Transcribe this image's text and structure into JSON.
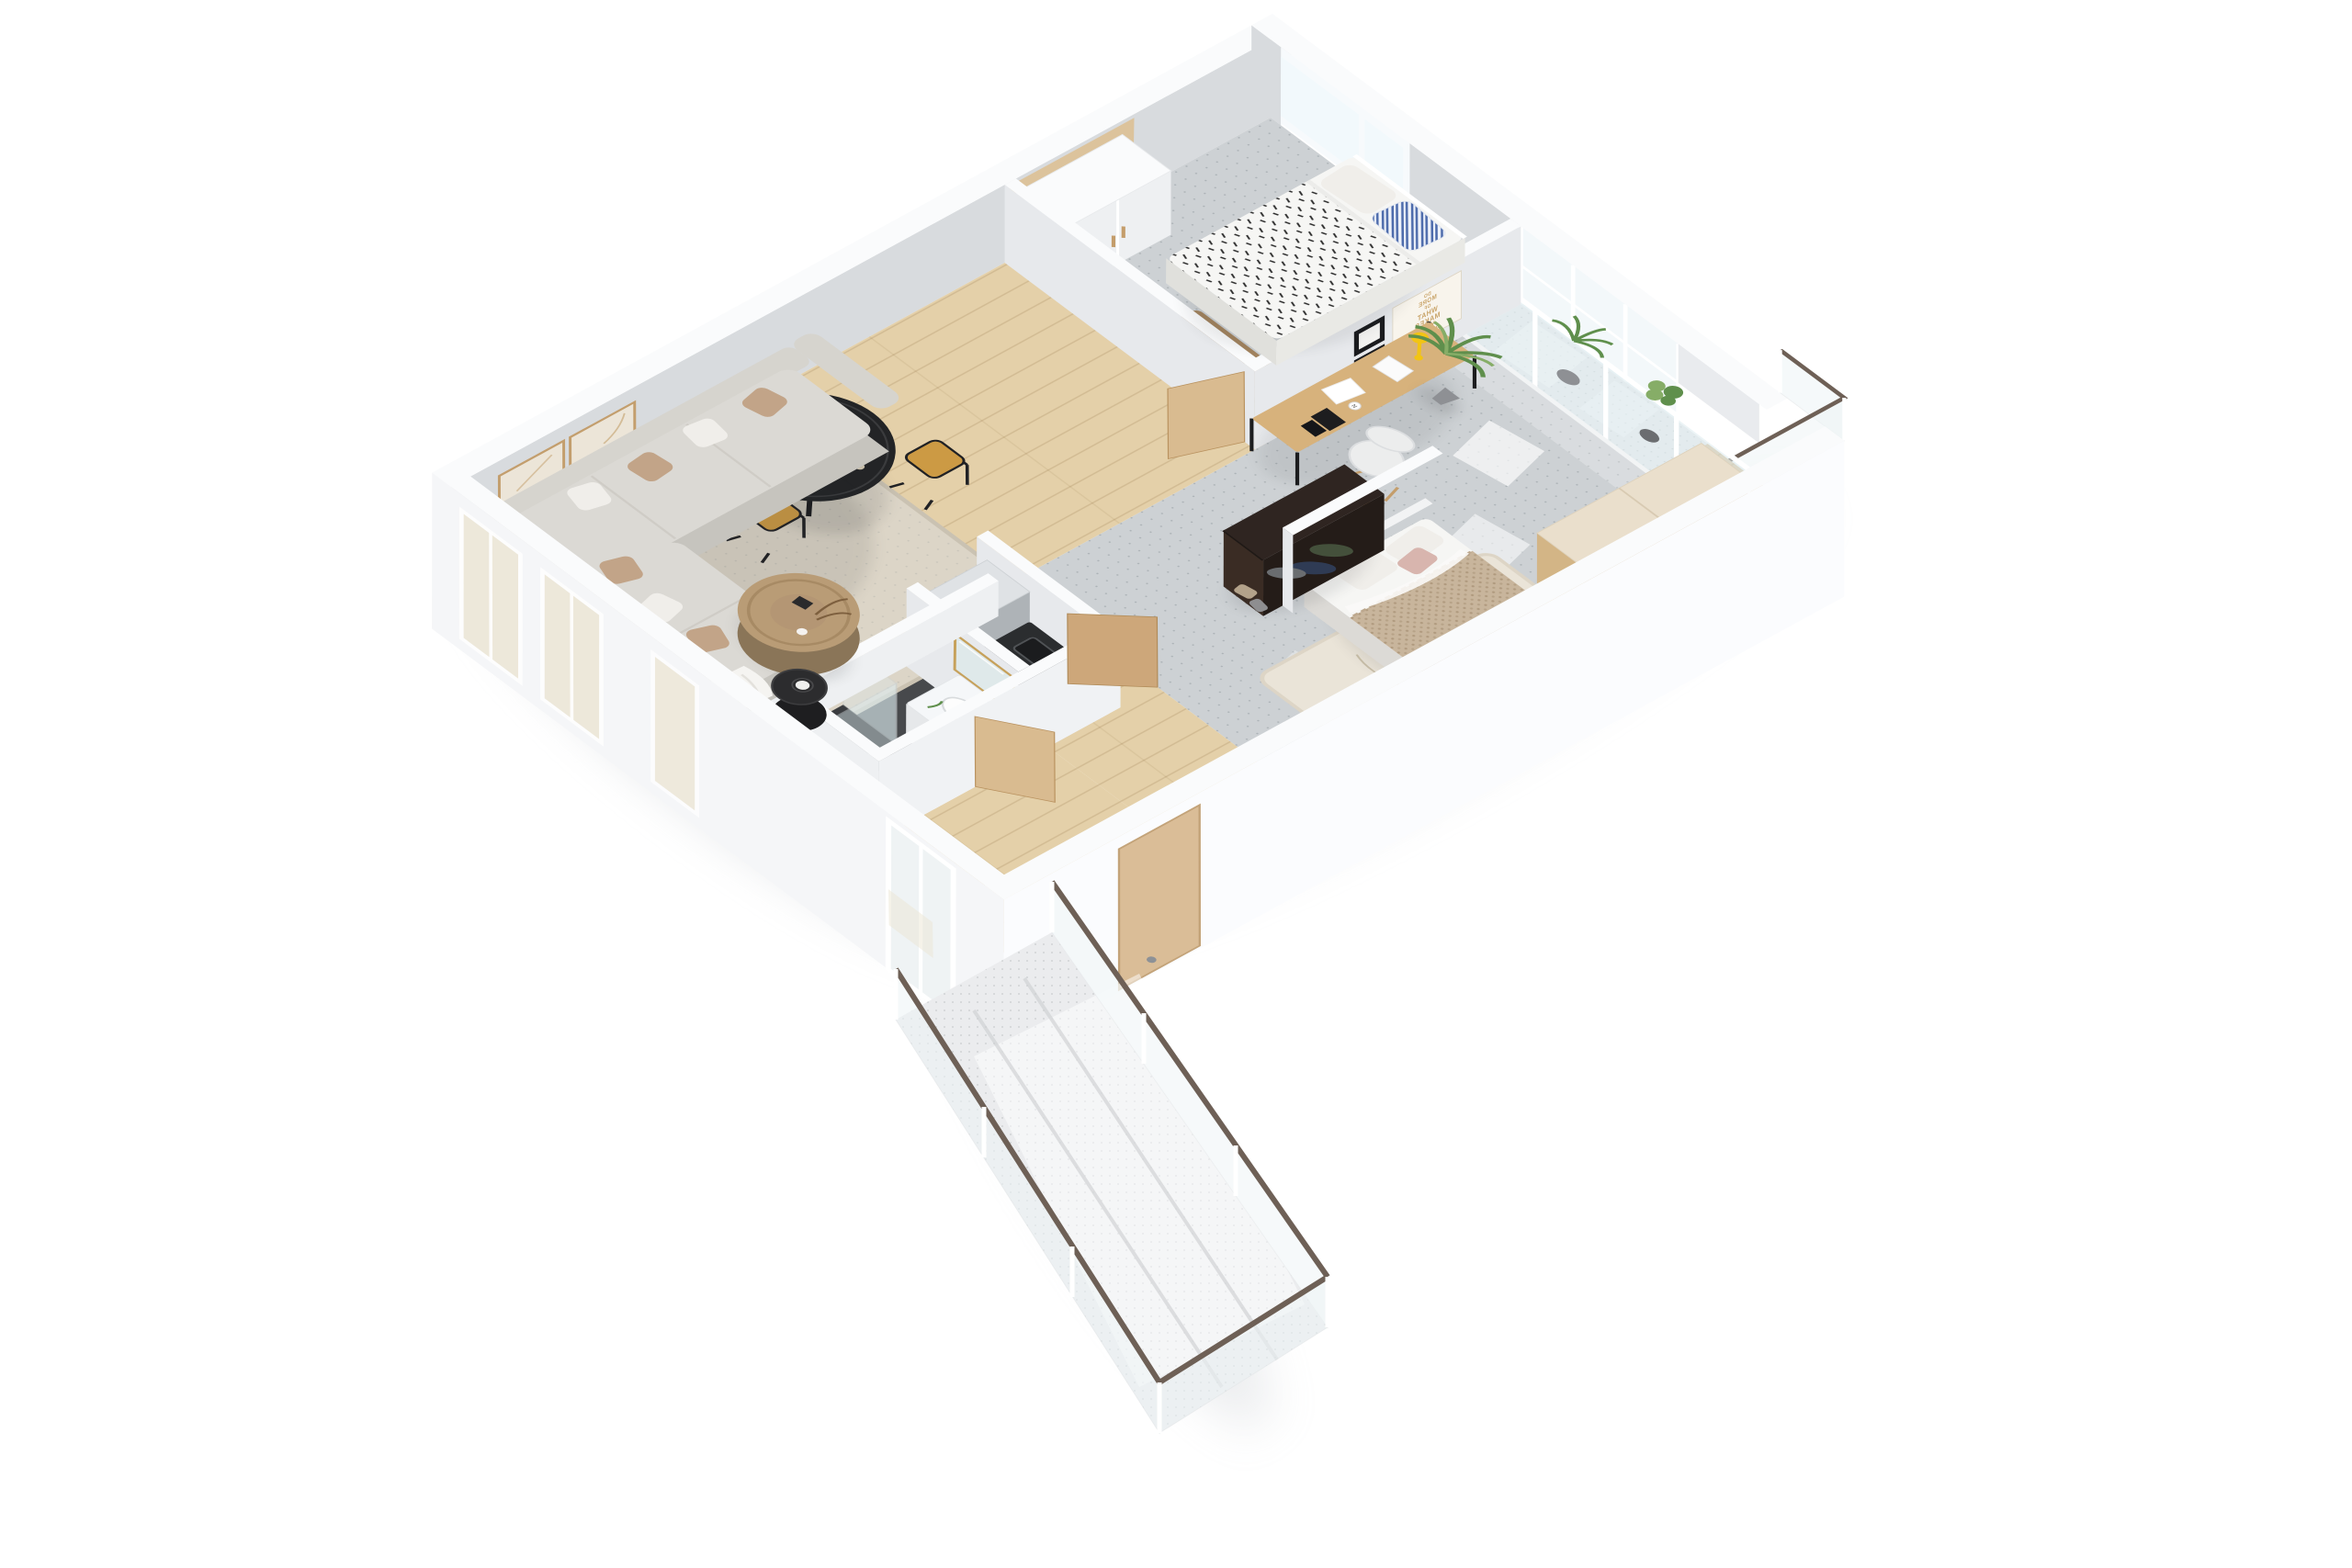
{
  "palette": {
    "bg": "#ffffff",
    "wallTop": "#fafbfc",
    "wallFace": "#d8dbde",
    "wallFaceLight": "#e7e9ec",
    "outerWall": "#f5f6f8",
    "outerWallBright": "#fbfcfe",
    "woodFloor": "#e4d0a9",
    "plankLine": "#d2ba8e",
    "carpet": "#cdd1d4",
    "carpetDot": "#9aa3a8",
    "bathFloor": "#47494c",
    "balconyFloor": "#ebecee",
    "deckWood": "#d9c29b",
    "woodPanel": "#dcc39c",
    "rugBeige": "#dcd5c7",
    "rugCream": "#eae4d8",
    "rugBrown": "#a3845f",
    "sofaBase": "#c6c4be",
    "sofaCushion": "#dbd9d4",
    "sofaBack": "#d6d4ce",
    "pillowTan": "#c2a488",
    "pillowWhite": "#f0eeea",
    "blanketWhite": "#f5f4f1",
    "tableBlack": "#232426",
    "rattan": "#cc9a44",
    "orangeFruit": "#e98e2b",
    "trunkWood": "#b99c76",
    "sideTableBlack": "#2c2c2e",
    "fridgeSteel": "#c6cacd",
    "fridgeSide": "#aeb3b7",
    "fridgeTop": "#dfe2e5",
    "counterDark": "#2b2d2f",
    "cabinetWhite": "#f1f2f4",
    "glass": "#dcebee",
    "skyGlass": "#f2f9fc",
    "winGlassNear": "#ece5d3",
    "doorWood": "#cda77a",
    "doorWoodLight": "#d9bb90",
    "entryDoor": "#dabd97",
    "gold": "#c6a15b",
    "mirrorGlass": "#dfe9ea",
    "knit": "#c8b59c",
    "pinkPillow": "#d8b5ae",
    "duvetWhite": "#f6f6f4",
    "stripeBlue": "#4e6cac",
    "coatDark": "#2f2521",
    "coatFace": "#3a2c24",
    "coatSide": "#241c18",
    "clothGreen": "#44503b",
    "clothNavy": "#2f3b54",
    "bagTan": "#b3a28a",
    "deskWood": "#d7b27c",
    "lampYellow": "#f2c414",
    "chairWhite": "#eceded",
    "legWood": "#c49d6b",
    "plantGreen": "#5f8f4c",
    "plantGreenLight": "#86ad67",
    "potGray": "#8e9094",
    "railMetal": "#6e6056",
    "glassRail": "#eef5f6",
    "shadowSoft": "#b9bec4",
    "sunPatch": "#ffffff",
    "posterGold": "#c9a469",
    "frameDark": "#1a1b1e",
    "frameTan": "#c39e6d",
    "artFill": "#ece5d8"
  },
  "poster": {
    "lines": [
      "DO",
      "MORE",
      "OF",
      "WHAT",
      "MAKES",
      "YOU",
      "HAPPY."
    ]
  },
  "desk": {
    "mug_letter": "N"
  },
  "scene": {
    "view": "3d-dollhouse-floorplan-top-down",
    "rooms": [
      {
        "name": "living-room",
        "items": [
          "sectional-sofa",
          "throw-pillows",
          "beige-area-rug",
          "trunk-coffee-table",
          "black-side-table",
          "wall-art-frames",
          "windows"
        ]
      },
      {
        "name": "dining-area",
        "items": [
          "round-black-table",
          "rattan-chairs",
          "oranges",
          "plates",
          "glasses"
        ]
      },
      {
        "name": "kitchen",
        "items": [
          "stainless-fridge",
          "dark-counter-with-sink",
          "hob"
        ]
      },
      {
        "name": "bathroom",
        "items": [
          "vanity-with-basin",
          "gold-mirror",
          "glass-shower",
          "toilet",
          "dark-tile-floor"
        ]
      },
      {
        "name": "hallway-entry",
        "items": [
          "coat-rack-with-clothes",
          "bags",
          "entry-door",
          "wood-doors"
        ]
      },
      {
        "name": "bedroom-small",
        "items": [
          "single-bed",
          "striped-pillow",
          "patterned-duvet",
          "built-in-closet",
          "brown-rug",
          "window"
        ]
      },
      {
        "name": "bedroom-large",
        "items": [
          "double-bed-knit-blanket",
          "cream-rug",
          "desk",
          "white-chair",
          "motivational-poster",
          "picture-frames",
          "wood-wardrobe",
          "potted-palm",
          "glazed-loggia"
        ]
      }
    ],
    "balconies": [
      {
        "name": "south-terrace",
        "items": [
          "glass-railing",
          "metal-handrail",
          "speckled-floor"
        ]
      },
      {
        "name": "north-loggia",
        "items": [
          "glazing",
          "parapet",
          "plants",
          "wood-deck",
          "corner-glass-railing"
        ]
      }
    ]
  }
}
